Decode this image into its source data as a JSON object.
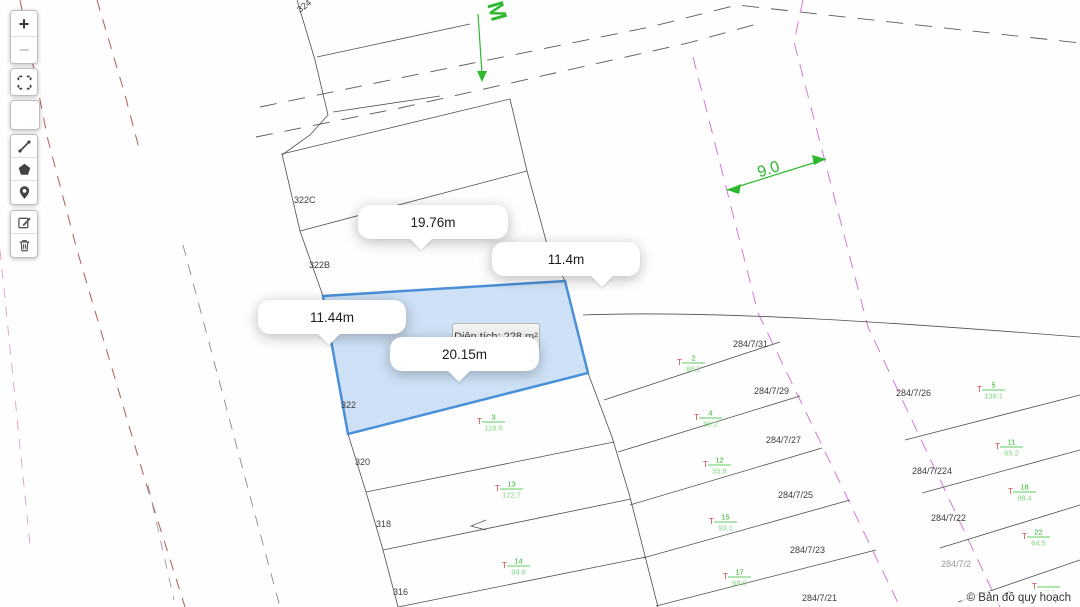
{
  "app": {
    "attribution": "© Bản đồ quy hoạch"
  },
  "toolbar": {
    "zoom_in": "+",
    "zoom_out": "−",
    "buttons": [
      "zoom-in",
      "zoom-out",
      "fullscreen",
      "blank",
      "measure-line",
      "draw-polygon",
      "add-marker",
      "edit",
      "delete"
    ]
  },
  "measure_tooltips": [
    {
      "label": "19.76m"
    },
    {
      "label": "11.4m"
    },
    {
      "label": "11.44m"
    },
    {
      "label": "20.15m"
    }
  ],
  "area_tooltip": {
    "label": "Diện tích: 228 m²"
  },
  "annotations": {
    "street_letter": "M",
    "road_width": "9.0"
  },
  "parcel_labels": [
    {
      "text": "324",
      "x": 300,
      "y": 13,
      "rot": -38
    },
    {
      "text": "322C",
      "x": 294,
      "y": 203,
      "rot": 0
    },
    {
      "text": "322B",
      "x": 309,
      "y": 268,
      "rot": 0
    },
    {
      "text": "322",
      "x": 341,
      "y": 408,
      "rot": 0
    },
    {
      "text": "320",
      "x": 355,
      "y": 465,
      "rot": 0
    },
    {
      "text": "318",
      "x": 376,
      "y": 527,
      "rot": 0
    },
    {
      "text": "316",
      "x": 393,
      "y": 595,
      "rot": 0
    },
    {
      "text": "284/7/31",
      "x": 733,
      "y": 347,
      "rot": 0
    },
    {
      "text": "284/7/29",
      "x": 754,
      "y": 394,
      "rot": 0
    },
    {
      "text": "284/7/27",
      "x": 766,
      "y": 443,
      "rot": 0
    },
    {
      "text": "284/7/25",
      "x": 778,
      "y": 498,
      "rot": 0
    },
    {
      "text": "284/7/23",
      "x": 790,
      "y": 553,
      "rot": 0
    },
    {
      "text": "284/7/21",
      "x": 802,
      "y": 601,
      "rot": 0
    },
    {
      "text": "284/7/26",
      "x": 896,
      "y": 396,
      "rot": 0
    },
    {
      "text": "284/7/224",
      "x": 912,
      "y": 474,
      "rot": 0
    },
    {
      "text": "284/7/22",
      "x": 931,
      "y": 521,
      "rot": 0
    },
    {
      "text": "284/7/2",
      "x": 941,
      "y": 567,
      "rot": 0,
      "faded": true
    }
  ],
  "owner_labels": [
    {
      "prefix": "T",
      "num": "2",
      "den": "88.2",
      "x": 690,
      "y": 362
    },
    {
      "prefix": "T",
      "num": "4",
      "den": "95.2",
      "x": 707,
      "y": 417
    },
    {
      "prefix": "T",
      "num": "12",
      "den": "55.8",
      "x": 716,
      "y": 464
    },
    {
      "prefix": "T",
      "num": "15",
      "den": "93.1",
      "x": 722,
      "y": 521
    },
    {
      "prefix": "T",
      "num": "17",
      "den": "68.0",
      "x": 736,
      "y": 576
    },
    {
      "prefix": "T",
      "num": "3",
      "den": "118.5",
      "x": 490,
      "y": 421
    },
    {
      "prefix": "T",
      "num": "13",
      "den": "122.7",
      "x": 508,
      "y": 488
    },
    {
      "prefix": "T",
      "num": "14",
      "den": "94.6",
      "x": 515,
      "y": 565
    },
    {
      "prefix": "T",
      "num": "5",
      "den": "138.1",
      "x": 990,
      "y": 389
    },
    {
      "prefix": "T",
      "num": "11",
      "den": "65.2",
      "x": 1008,
      "y": 446
    },
    {
      "prefix": "T",
      "num": "18",
      "den": "88.4",
      "x": 1021,
      "y": 491
    },
    {
      "prefix": "T",
      "num": "22",
      "den": "64.5",
      "x": 1035,
      "y": 536
    },
    {
      "prefix": "T",
      "num": "",
      "den": "65.0",
      "x": 1045,
      "y": 586
    }
  ],
  "colors": {
    "highlight_stroke": "#4a90d9",
    "highlight_fill": "#aecdf0",
    "annotation_green": "#2db82d",
    "planning_pink": "#d678d6",
    "boundary_red": "#b05a5a",
    "owner_red": "#cc4444",
    "owner_green": "#2db82d",
    "owner_green_light": "#7dd87d",
    "parcel_line": "#4f4f4f"
  }
}
